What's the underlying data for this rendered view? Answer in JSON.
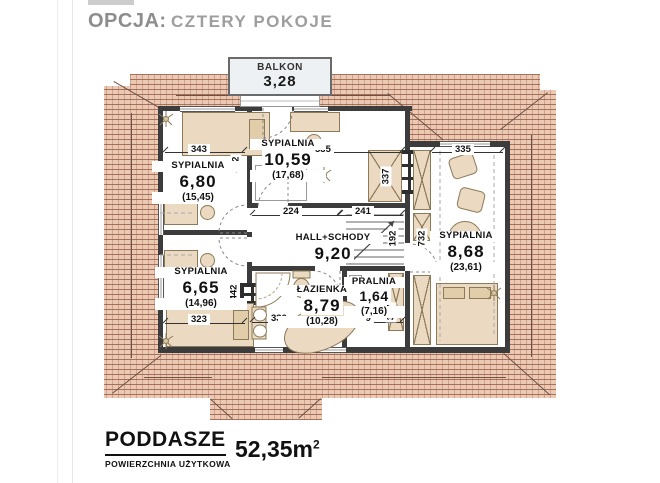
{
  "title": {
    "prefix": "OPCJA:",
    "variant": "CZTERY POKOJE"
  },
  "balcony": {
    "name": "BALKON",
    "area": "3,28"
  },
  "rooms": {
    "s680": {
      "name": "SYPIALNIA",
      "area": "6,80",
      "gross": "(15,45)"
    },
    "s1059": {
      "name": "SYPIALNIA",
      "area": "10,59",
      "gross": "(17,68)"
    },
    "s868": {
      "name": "SYPIALNIA",
      "area": "8,68",
      "gross": "(23,61)"
    },
    "hall": {
      "name": "HALL+SCHODY",
      "area": "9,20"
    },
    "s665": {
      "name": "SYPIALNIA",
      "area": "6,65",
      "gross": "(14,96)"
    },
    "laz": {
      "name": "ŁAZIENKA",
      "area": "8,79",
      "gross": "(10,28)"
    },
    "pra": {
      "name": "PRALNIA",
      "area": "1,64",
      "gross": "(7,16)"
    }
  },
  "dims": {
    "top_left": "343",
    "left_top_v": "442",
    "center_top": "535",
    "center_right_v": "337",
    "right_top": "335",
    "hall_left": "224",
    "hall_right": "241",
    "stairs_v": "192",
    "right_side_v": "732",
    "bottom_left": "323",
    "left_bottom_v": "442",
    "bath_bottom": "330",
    "pralnia_bottom": "219",
    "pralnia_right_v": "337"
  },
  "footer": {
    "level": "PODDASZE",
    "label": "POWIERZCHNIA UŻYTKOWA",
    "area": "52,35m",
    "area_exp": "2"
  },
  "colors": {
    "roof_tile": "#ecc9b3",
    "roof_mortar": "#a5705c",
    "wall": "#3c3c3c",
    "furniture": "#ebdac1",
    "text": "#111111",
    "title_gray": "#949494"
  }
}
